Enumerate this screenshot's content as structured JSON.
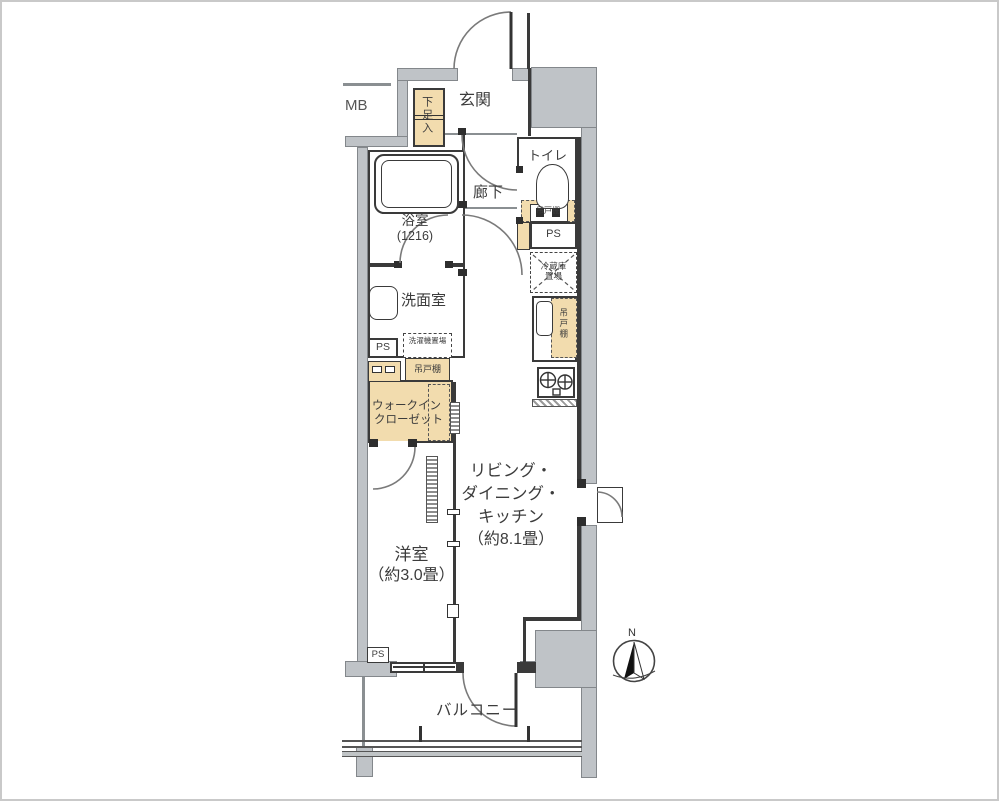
{
  "floor_plan": {
    "labels": {
      "mb": "MB",
      "entrance": "玄関",
      "shoe_cabinet": "下足入",
      "hallway": "廊下",
      "toilet": "トイレ",
      "bathroom": "浴室",
      "bathroom_size": "(1216)",
      "washroom": "洗面室",
      "pipe_space": "PS",
      "washer_space": "洗濯機置場",
      "hanging_cupboard": "吊戸棚",
      "fridge_line1": "冷蔵庫",
      "fridge_line2": "置場",
      "wic_line1": "ウォークイン",
      "wic_line2": "クローゼット",
      "ldk_line1": "リビング・",
      "ldk_line2": "ダイニング・",
      "ldk_line3": "キッチン",
      "ldk_line4": "（約8.1畳）",
      "western_room": "洋室",
      "western_room_size": "（約3.0畳）",
      "balcony": "バルコニー",
      "compass_north": "N"
    },
    "colors": {
      "cabinet_fill": "#f2dcae",
      "common_wall_gray": "#bfc3c7",
      "wall_line": "#3a3a3a"
    }
  }
}
